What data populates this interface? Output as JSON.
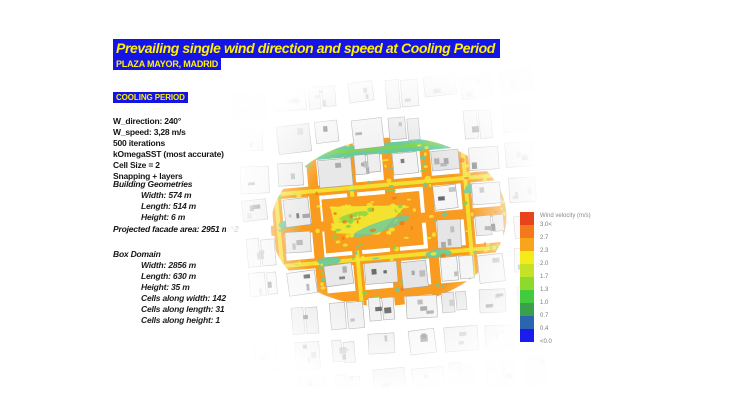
{
  "title": {
    "main": "Prevailing single wind direction and speed at Cooling Period",
    "subtitle": "PLAZA MAYOR, MADRID"
  },
  "badge": "COOLING PERIOD",
  "parameters": [
    "W_direction: 240°",
    "W_speed: 3,28 m/s",
    "500 iterations",
    "kOmegaSST (most accurate)",
    "Cell Size = 2",
    "Snapping + layers"
  ],
  "building_geometries": {
    "heading": "Building Geometries",
    "lines": [
      "Width: 574 m",
      "Length: 514 m",
      "Height: 6 m"
    ]
  },
  "projected_facade": "Projected facade area: 2951 m^2",
  "box_domain": {
    "heading": "Box Domain",
    "lines": [
      "Width: 2856 m",
      "Length: 630 m",
      "Height: 35 m",
      "Cells along width: 142",
      "Cells along length: 31",
      "Cells along height: 1"
    ]
  },
  "legend": {
    "title": "Wind velocity (m/s)",
    "entries": [
      {
        "label": "3.0<",
        "color": "#e8431c"
      },
      {
        "label": "2.7",
        "color": "#f4791d"
      },
      {
        "label": "2.3",
        "color": "#f9a51b"
      },
      {
        "label": "2.0",
        "color": "#f4eb1d"
      },
      {
        "label": "1.7",
        "color": "#c5e226"
      },
      {
        "label": "1.3",
        "color": "#8bda2c"
      },
      {
        "label": "1.0",
        "color": "#43cb3e"
      },
      {
        "label": "0.7",
        "color": "#3ba04b"
      },
      {
        "label": "0.4",
        "color": "#2d64af"
      },
      {
        "label": "<0.0",
        "color": "#1b1bee"
      }
    ]
  },
  "colors": {
    "highlight_bg": "#1414e6",
    "highlight_text": "#fff100",
    "map_orange": "#f89b1e",
    "map_orange_deep": "#f07c12",
    "map_yellow": "#f2e731",
    "map_teal": "#66cba0",
    "map_green": "#84d348",
    "building_fill": "#ececec",
    "building_stroke": "#a5a5a5"
  }
}
